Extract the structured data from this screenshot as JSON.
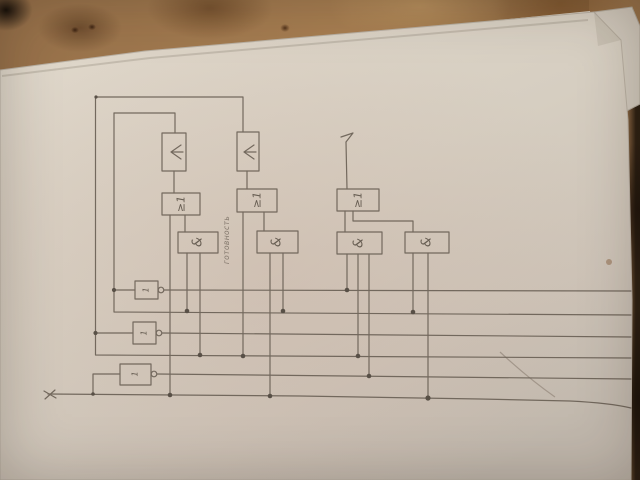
{
  "labels": {
    "or_gate": "≥1",
    "and_gate": "&",
    "not_gate": "1",
    "note": "готовность",
    "input_signal": "x"
  },
  "colors": {
    "paper": "#d7cfc2",
    "table": "#a1794e",
    "ink": "#6b6156",
    "junction_dot": "#4f473e"
  }
}
